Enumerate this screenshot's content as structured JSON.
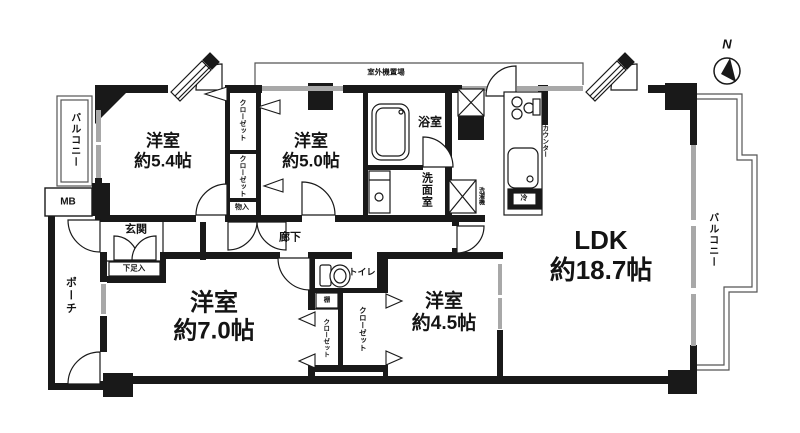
{
  "compass": {
    "north": "N"
  },
  "areas": {
    "balcony": "バルコニー",
    "porch": "ポーチ",
    "meter_box": "MB",
    "outdoor_unit_space": "室外機置場",
    "entrance": "玄関",
    "shoe_cabinet": "下足入",
    "hallway": "廊下",
    "toilet": "トイレ",
    "bathroom": "浴室",
    "washroom": "洗面室",
    "washer_space": "洗濯機",
    "kitchen_counter": "カウンター",
    "fridge": "冷",
    "shelf": "棚",
    "storage": "物入",
    "closet": "クローゼット"
  },
  "rooms": {
    "bedroom_5_4": {
      "name": "洋室",
      "size": "約5.4帖"
    },
    "bedroom_5_0": {
      "name": "洋室",
      "size": "約5.0帖"
    },
    "bedroom_7_0": {
      "name": "洋室",
      "size": "約7.0帖"
    },
    "bedroom_4_5": {
      "name": "洋室",
      "size": "約4.5帖"
    },
    "ldk": {
      "name": "LDK",
      "size": "約18.7帖"
    }
  },
  "colors": {
    "wall": "#191919",
    "window": "#a8a8a8",
    "outline": "#555555",
    "background": "#ffffff"
  }
}
